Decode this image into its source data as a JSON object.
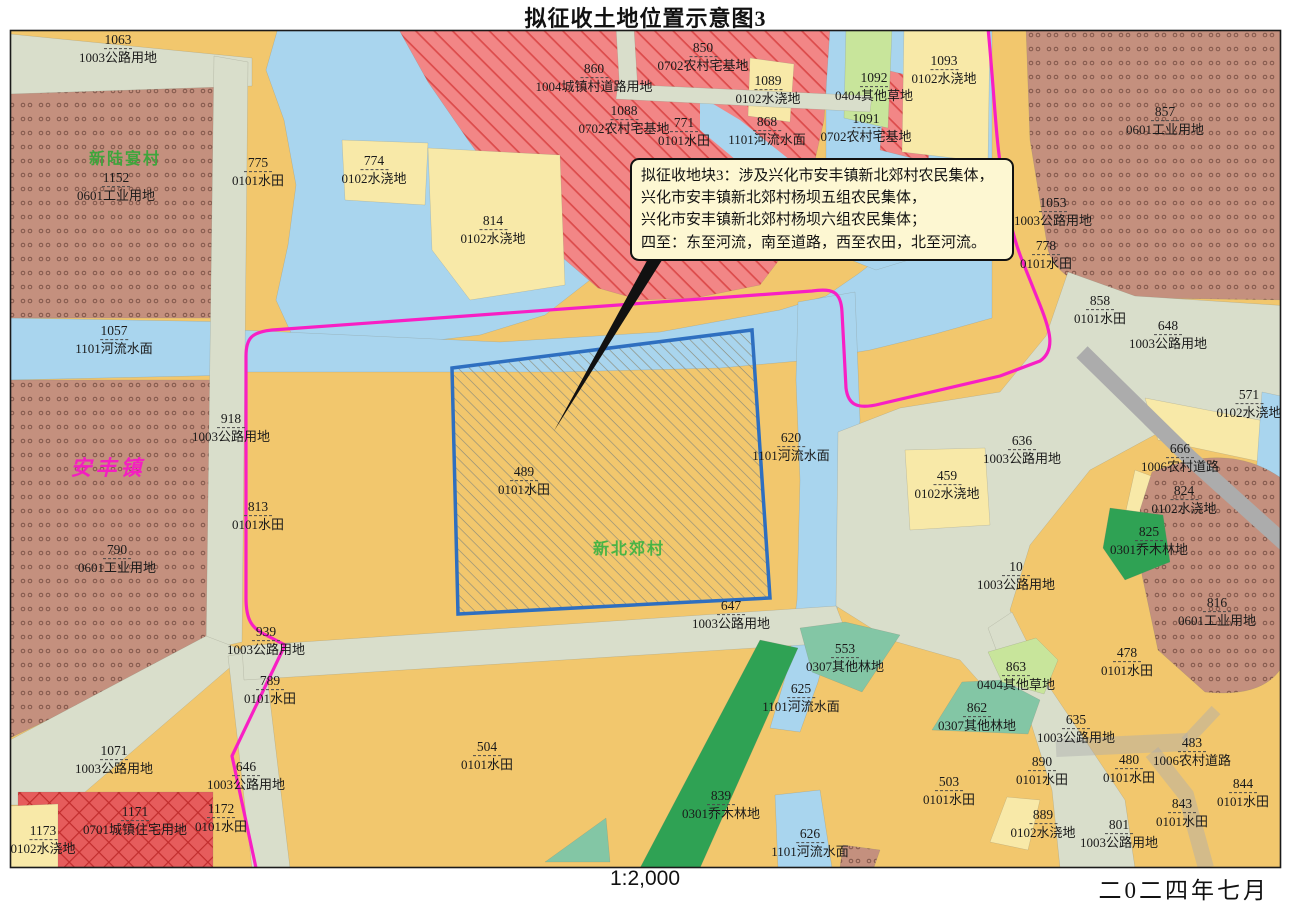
{
  "title": "拟征收土地位置示意图3",
  "scale": "1:2,000",
  "date": "二0二四年七月",
  "callout": {
    "lines": [
      "拟征收地块3：涉及兴化市安丰镇新北郊村农民集体，",
      "兴化市安丰镇新北郊村杨坝五组农民集体，",
      "兴化市安丰镇新北郊村杨坝六组农民集体；",
      "四至：东至河流，南至道路，西至农田，北至河流。"
    ]
  },
  "places": [
    {
      "name": "新陆宴村",
      "kind": "village",
      "color": "#3FA53C",
      "x": 125,
      "y": 157
    },
    {
      "name": "安丰镇",
      "kind": "town",
      "color": "#F41FC0",
      "x": 108,
      "y": 467
    },
    {
      "name": "新北郊村",
      "kind": "village",
      "color": "#49B445",
      "x": 629,
      "y": 547
    }
  ],
  "parcels": [
    {
      "num": "1063",
      "type": "1003公路用地",
      "x": 118,
      "y": 49
    },
    {
      "num": "1152",
      "type": "0601工业用地",
      "x": 116,
      "y": 187
    },
    {
      "num": "775",
      "type": "0101水田",
      "x": 258,
      "y": 172
    },
    {
      "num": "774",
      "type": "0102水浇地",
      "x": 374,
      "y": 170
    },
    {
      "num": "860",
      "type": "1004城镇村道路用地",
      "x": 594,
      "y": 78
    },
    {
      "num": "850",
      "type": "0702农村宅基地",
      "x": 703,
      "y": 57
    },
    {
      "num": "1088",
      "type": "0702农村宅基地",
      "x": 624,
      "y": 120
    },
    {
      "num": "771",
      "type": "0101水田",
      "x": 684,
      "y": 132
    },
    {
      "num": "1089",
      "type": "0102水浇地",
      "x": 768,
      "y": 90
    },
    {
      "num": "868",
      "type": "1101河流水面",
      "x": 767,
      "y": 131
    },
    {
      "num": "1092",
      "type": "0404其他草地",
      "x": 874,
      "y": 87
    },
    {
      "num": "1091",
      "type": "0702农村宅基地",
      "x": 866,
      "y": 128
    },
    {
      "num": "1093",
      "type": "0102水浇地",
      "x": 944,
      "y": 70
    },
    {
      "num": "857",
      "type": "0601工业用地",
      "x": 1165,
      "y": 121
    },
    {
      "num": "1053",
      "type": "1003公路用地",
      "x": 1053,
      "y": 212
    },
    {
      "num": "778",
      "type": "0101水田",
      "x": 1046,
      "y": 255
    },
    {
      "num": "814",
      "type": "0102水浇地",
      "x": 493,
      "y": 230
    },
    {
      "num": "1057",
      "type": "1101河流水面",
      "x": 114,
      "y": 340
    },
    {
      "num": "918",
      "type": "1003公路用地",
      "x": 231,
      "y": 428
    },
    {
      "num": "858",
      "type": "0101水田",
      "x": 1100,
      "y": 310
    },
    {
      "num": "648",
      "type": "1003公路用地",
      "x": 1168,
      "y": 335
    },
    {
      "num": "571",
      "type": "0102水浇地",
      "x": 1249,
      "y": 404
    },
    {
      "num": "813",
      "type": "0101水田",
      "x": 258,
      "y": 516
    },
    {
      "num": "790",
      "type": "0601工业用地",
      "x": 117,
      "y": 559
    },
    {
      "num": "489",
      "type": "0101水田",
      "x": 524,
      "y": 481
    },
    {
      "num": "620",
      "type": "1101河流水面",
      "x": 791,
      "y": 447
    },
    {
      "num": "636",
      "type": "1003公路用地",
      "x": 1022,
      "y": 450
    },
    {
      "num": "459",
      "type": "0102水浇地",
      "x": 947,
      "y": 485
    },
    {
      "num": "666",
      "type": "1006农村道路",
      "x": 1180,
      "y": 458
    },
    {
      "num": "824",
      "type": "0102水浇地",
      "x": 1184,
      "y": 500
    },
    {
      "num": "825",
      "type": "0301乔木林地",
      "x": 1149,
      "y": 541
    },
    {
      "num": "10",
      "type": "1003公路用地",
      "x": 1016,
      "y": 576
    },
    {
      "num": "816",
      "type": "0601工业用地",
      "x": 1217,
      "y": 612
    },
    {
      "num": "647",
      "type": "1003公路用地",
      "x": 731,
      "y": 615
    },
    {
      "num": "939",
      "type": "1003公路用地",
      "x": 266,
      "y": 641
    },
    {
      "num": "789",
      "type": "0101水田",
      "x": 270,
      "y": 690
    },
    {
      "num": "553",
      "type": "0307其他林地",
      "x": 845,
      "y": 658
    },
    {
      "num": "625",
      "type": "1101河流水面",
      "x": 801,
      "y": 698
    },
    {
      "num": "863",
      "type": "0404其他草地",
      "x": 1016,
      "y": 676
    },
    {
      "num": "862",
      "type": "0307其他林地",
      "x": 977,
      "y": 717
    },
    {
      "num": "478",
      "type": "0101水田",
      "x": 1127,
      "y": 662
    },
    {
      "num": "635",
      "type": "1003公路用地",
      "x": 1076,
      "y": 729
    },
    {
      "num": "504",
      "type": "0101水田",
      "x": 487,
      "y": 756
    },
    {
      "num": "839",
      "type": "0301乔木林地",
      "x": 721,
      "y": 805
    },
    {
      "num": "626",
      "type": "1101河流水面",
      "x": 810,
      "y": 843
    },
    {
      "num": "890",
      "type": "0101水田",
      "x": 1042,
      "y": 771
    },
    {
      "num": "503",
      "type": "0101水田",
      "x": 949,
      "y": 791
    },
    {
      "num": "889",
      "type": "0102水浇地",
      "x": 1043,
      "y": 824
    },
    {
      "num": "801",
      "type": "1003公路用地",
      "x": 1119,
      "y": 834
    },
    {
      "num": "483",
      "type": "1006农村道路",
      "x": 1192,
      "y": 752
    },
    {
      "num": "843",
      "type": "0101水田",
      "x": 1182,
      "y": 813
    },
    {
      "num": "844",
      "type": "0101水田",
      "x": 1243,
      "y": 793
    },
    {
      "num": "480",
      "type": "0101水田",
      "x": 1129,
      "y": 769
    },
    {
      "num": "1071",
      "type": "1003公路用地",
      "x": 114,
      "y": 760
    },
    {
      "num": "646",
      "type": "1003公路用地",
      "x": 246,
      "y": 776
    },
    {
      "num": "1172",
      "type": "0101水田",
      "x": 221,
      "y": 818
    },
    {
      "num": "1171",
      "type": "0701城镇住宅用地",
      "x": 135,
      "y": 821
    },
    {
      "num": "1173",
      "type": "0102水浇地",
      "x": 43,
      "y": 840
    }
  ],
  "colors": {
    "paddy": "#F2C76D",
    "irrigated": "#F8E9A8",
    "water": "#A9D5EE",
    "roadLight": "#D9DECB",
    "roadDark": "#ACACAC",
    "industrial": "#C4907E",
    "industrialDot": "#80564A",
    "homestead": "#F28686",
    "homesteadLine": "#DC4B4B",
    "urban": "#E65C5C",
    "urbanLine": "#C12D2D",
    "forestDark": "#2FA254",
    "forestMid": "#83C6A5",
    "grassLight": "#C8E59B",
    "boundary": "#F81FC4",
    "parcelStroke": "#2E6FC0",
    "parcelHatch": "#8D8D7B",
    "calloutBg": "#FDF7D2",
    "labelText": "#1A1A1A"
  }
}
